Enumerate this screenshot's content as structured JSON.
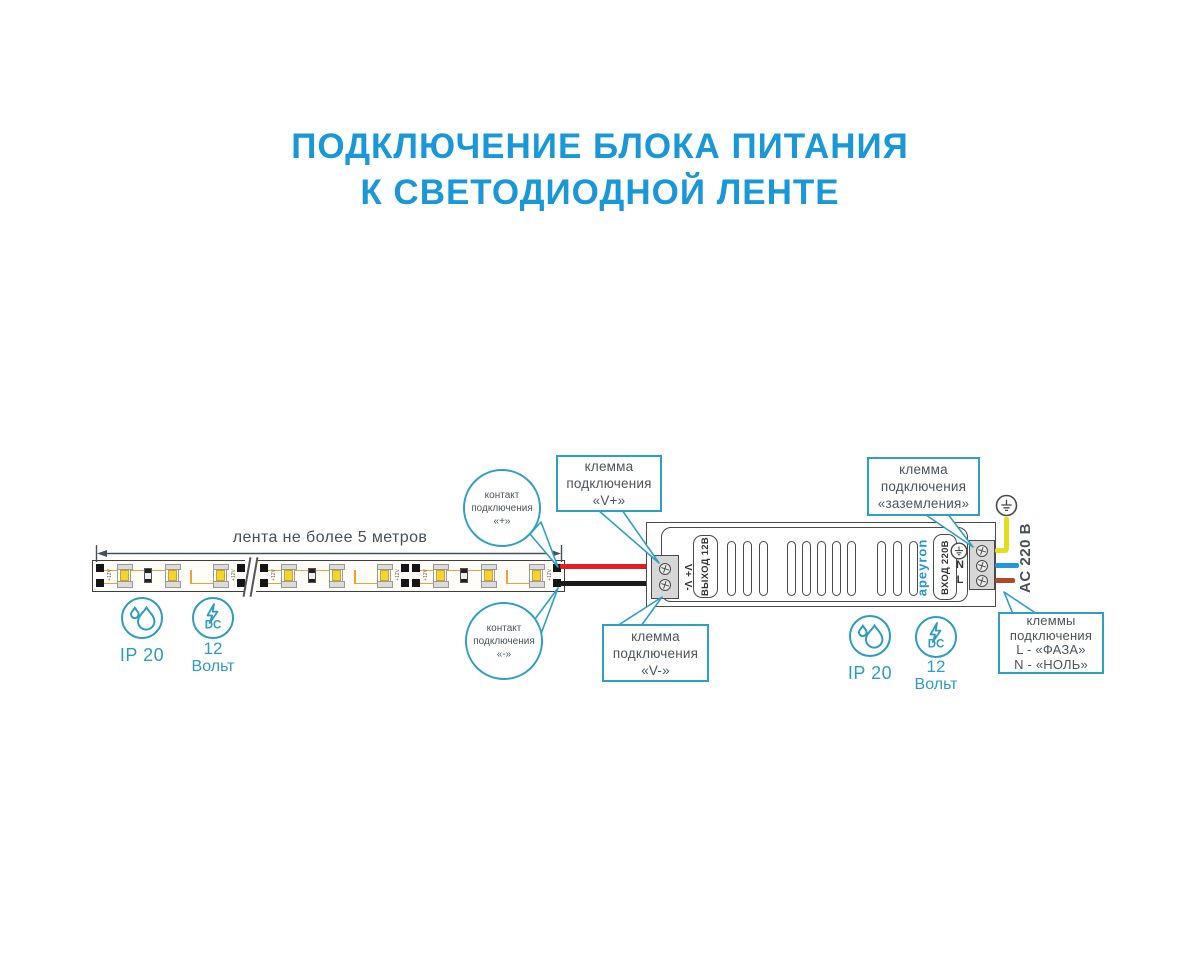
{
  "title": {
    "line1": "ПОДКЛЮЧЕНИЕ БЛОКА ПИТАНИЯ",
    "line2": "К СВЕТОДИОДНОЙ ЛЕНТЕ"
  },
  "strip": {
    "dimension_label": "лента не более 5 метров",
    "pad_label": "+12V"
  },
  "badges": {
    "ip_label": "IP 20",
    "dc_text": "DC",
    "volt_value": "12",
    "volt_unit": "Вольт"
  },
  "psu": {
    "output_port_label": "V+ V-",
    "output_label": "ВЫХОД 12В",
    "brand": "apeyron",
    "input_label": "ВХОД 220В",
    "neutral_label": "N",
    "line_label": "L",
    "ac_label": "AC 220 В"
  },
  "callouts": {
    "contact_plus": {
      "l1": "контакт",
      "l2": "подключения",
      "l3": "«+»"
    },
    "contact_minus": {
      "l1": "контакт",
      "l2": "подключения",
      "l3": "«-»"
    },
    "terminal_vplus": {
      "l1": "клемма",
      "l2": "подключения",
      "l3": "«V+»"
    },
    "terminal_vminus": {
      "l1": "клемма",
      "l2": "подключения",
      "l3": "«V-»"
    },
    "terminal_ground": {
      "l1": "клемма",
      "l2": "подключения",
      "l3": "«заземления»"
    },
    "terminal_ln": {
      "l1": "клеммы",
      "l2": "подключения",
      "l3": "L - «ФАЗА»",
      "l4": "N - «НОЛЬ»"
    }
  },
  "colors": {
    "accent_blue": "#1a97d6",
    "callout_teal": "#2f9fc4",
    "wire_positive": "#e01e23",
    "wire_negative": "#1b1b1b",
    "wire_ground": "#e3df1e",
    "wire_neutral": "#2196d9",
    "wire_line": "#ad4a28"
  }
}
